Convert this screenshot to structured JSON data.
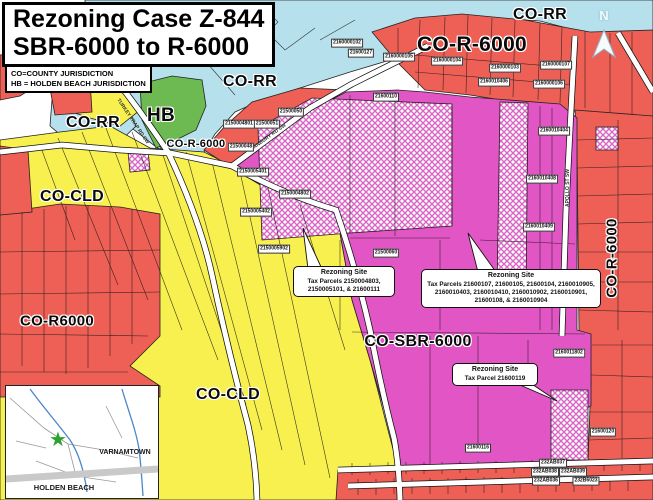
{
  "title": {
    "line1": "Rezoning Case Z-844",
    "line2": "SBR-6000 to R-6000"
  },
  "legend": {
    "line1": "CO=COUNTY JURISDICTION",
    "line2": "HB = HOLDEN BEACH JURISDICTION"
  },
  "north_label": "N",
  "zone_labels": {
    "co_rr_top_right": "CO-RR",
    "co_r6000_top": "CO-R-6000",
    "co_rr_mid": "CO-RR",
    "co_rr_left": "CO-RR",
    "hb": "HB",
    "co_r6000_small": "CO-R-6000",
    "co_cld_upper": "CO-CLD",
    "co_r6000_left": "CO-R6000",
    "co_cld_lower": "CO-CLD",
    "co_sbr": "CO-SBR-6000",
    "co_r6000_right": "CO-R-6000"
  },
  "roads": {
    "turkey_trap": "TURKEY TRAP RD SW",
    "stanbury": "STANBURY RD SW",
    "apollo": "APOLLO ST SW"
  },
  "parcels": [
    "2150005201",
    "2160000102",
    "21600127",
    "2160000105",
    "2160000104",
    "2160000103",
    "2160000107",
    "2160010406",
    "2160000106",
    "21600110",
    "21500050",
    "2150004801",
    "21500051",
    "21500048",
    "2150005401",
    "2150004802",
    "2150005402",
    "2150005902",
    "21500060",
    "2160010404",
    "2160010408",
    "2160010409",
    "2160011802",
    "21600120",
    "21600116",
    "232AB037",
    "232AB038",
    "232AB039",
    "232AB036",
    "232B6023"
  ],
  "callouts": {
    "c1": {
      "title": "Rezoning Site",
      "body": "Tax Parcels 2150004803, 2150005101, & 21600111"
    },
    "c2": {
      "title": "Rezoning Site",
      "body": "Tax Parcels 21600107, 21600105, 21600104, 2160010905, 2160010403, 2160010410, 2160010902, 2160010901, 21600108, & 2160010904"
    },
    "c3": {
      "title": "Rezoning Site",
      "body": "Tax Parcel 21600119"
    }
  },
  "inset": {
    "varnamtown": "VARNAMTOWN",
    "holden_beach": "HOLDEN BEACH",
    "star_icon": "★"
  },
  "colors": {
    "county_rr_blue": "#b5e0ec",
    "r6000_red": "#ee5f55",
    "cld_yellow": "#f7f04e",
    "sbr_magenta": "#e255c5",
    "hb_green": "#6db952",
    "hatch_pink": "#d965c5",
    "road_white": "#ffffff"
  }
}
